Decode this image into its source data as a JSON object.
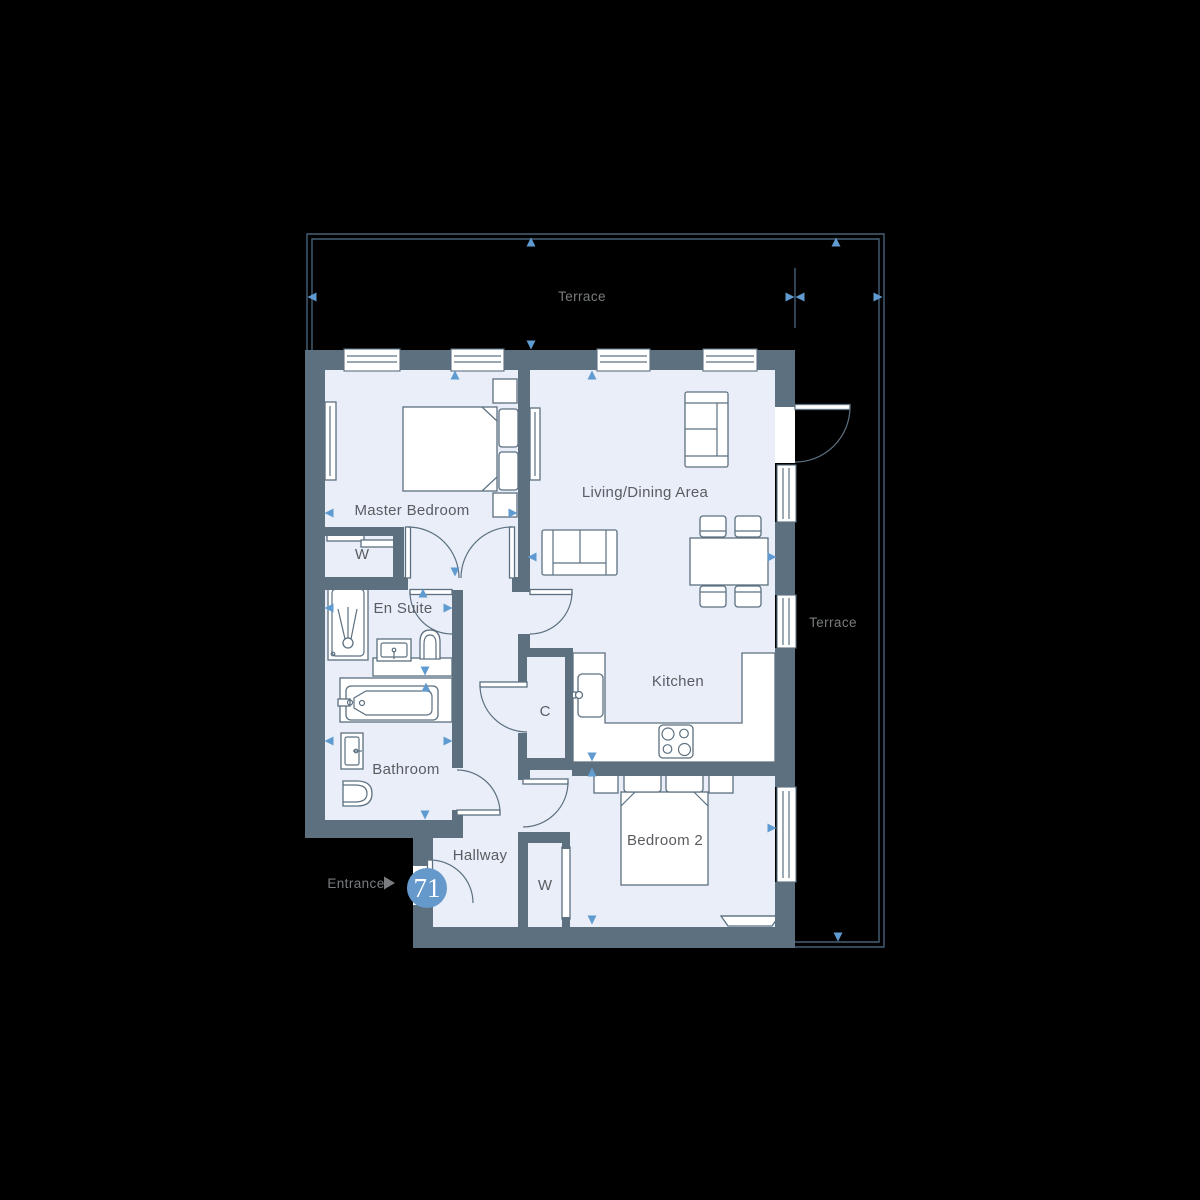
{
  "plan": {
    "unit_number": "71",
    "entrance_label": "Entrance",
    "rooms": {
      "terrace_top": "Terrace",
      "terrace_right": "Terrace",
      "master_bedroom": "Master Bedroom",
      "living_dining": "Living/Dining Area",
      "en_suite": "En Suite",
      "bathroom": "Bathroom",
      "hallway": "Hallway",
      "kitchen": "Kitchen",
      "bedroom_2": "Bedroom 2",
      "wardrobe_master": "W",
      "wardrobe_bedroom_2": "W",
      "cupboard": "C"
    },
    "colors": {
      "bg": "#000000",
      "wall": "#5c7080",
      "floor": "#e9eef8",
      "terrace_line": "#456078",
      "label": "#595d61",
      "muted_label": "#797c7f",
      "arrow": "#5f9bd0",
      "badge": "#6699cb"
    }
  }
}
